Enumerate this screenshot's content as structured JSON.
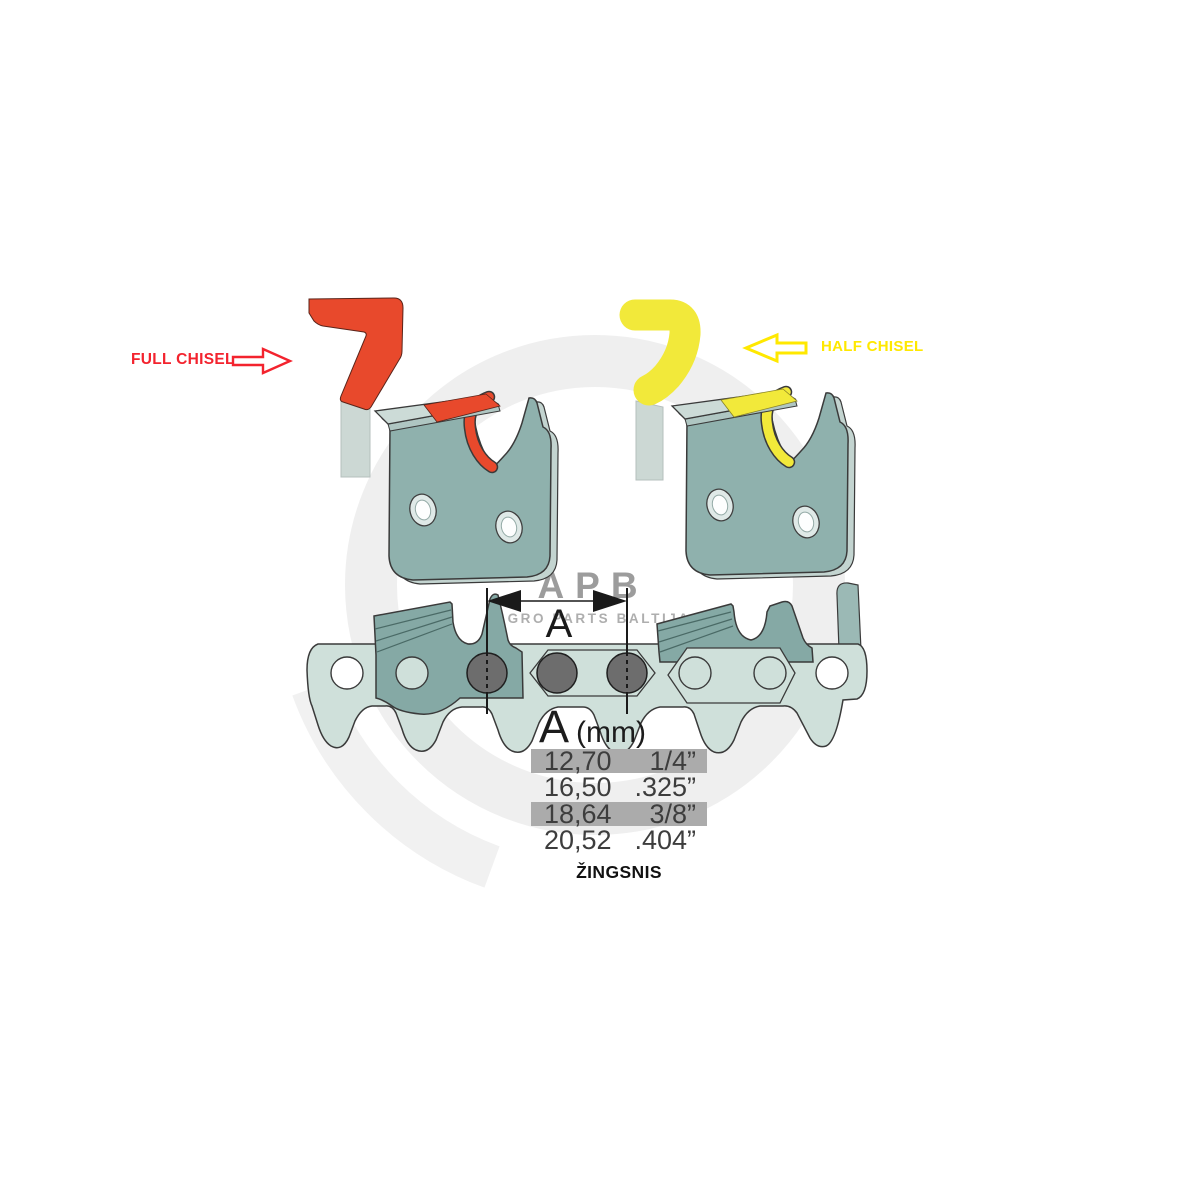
{
  "labels": {
    "full_chisel": "FULL CHISEL",
    "half_chisel": "HALF CHISEL",
    "dimension": "A",
    "caption": "ŽINGSNIS"
  },
  "watermark": {
    "logo": "APB",
    "subtitle": "AGRO PARTS BALTIJA"
  },
  "pitch_table": {
    "header_letter": "A",
    "header_unit": "(mm)",
    "rows": [
      {
        "mm": "12,70",
        "inch": "1/4”",
        "highlighted": true
      },
      {
        "mm": "16,50",
        "inch": ".325”",
        "highlighted": false
      },
      {
        "mm": "18,64",
        "inch": "3/8”",
        "highlighted": true
      },
      {
        "mm": "20,52",
        "inch": ".404”",
        "highlighted": false
      }
    ]
  },
  "colors": {
    "full_chisel_accent": "#e8492c",
    "full_chisel_label": "#f3232e",
    "half_chisel_accent": "#f2e93a",
    "half_chisel_label": "#ffe800",
    "link_steel": "#8fb1ad",
    "chain_strap": "#cfe0da",
    "cutter_dark": "#85a9a5",
    "table_highlight": "#ababab",
    "watermark_gray": "#efefef"
  }
}
